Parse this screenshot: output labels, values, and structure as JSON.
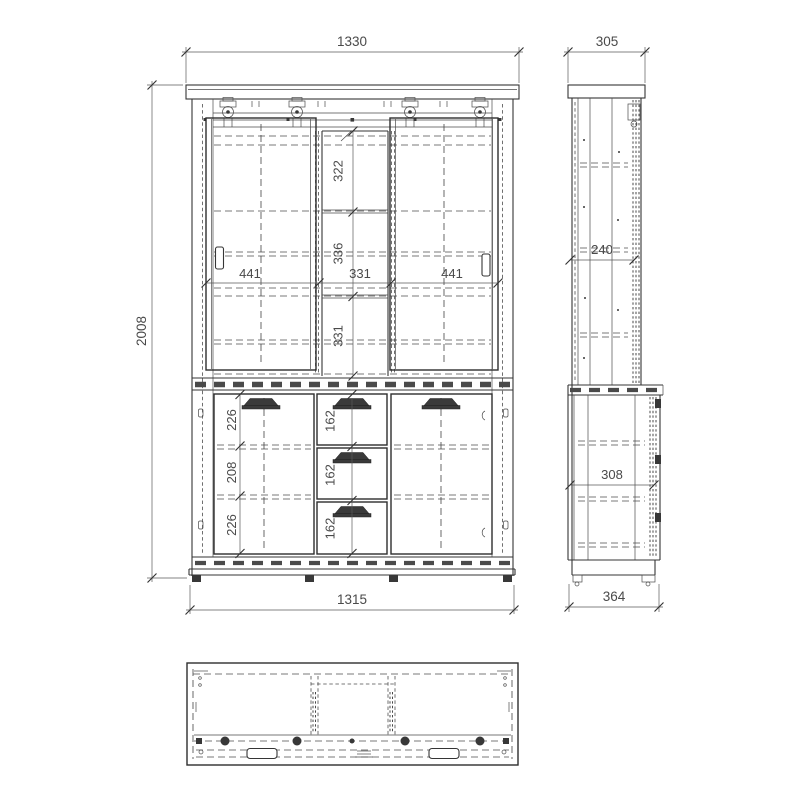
{
  "page": {
    "background": "#ffffff",
    "line_color": "#3a3a3a",
    "dim_text_color": "#4a4a4a"
  },
  "drawing": {
    "type": "furniture-technical-drawing",
    "subject": "display-cabinet-with-sliding-doors",
    "views": {
      "front": {
        "overall_width_mm": "1330",
        "overall_height_mm": "2008",
        "base_width_mm": "1315",
        "left_sliding_door_width_mm": "441",
        "center_section_width_mm": "331",
        "right_sliding_door_width_mm": "441",
        "upper_compartment_heights_mm": [
          "322",
          "336",
          "331"
        ],
        "lower_left_compartment_heights_mm": [
          "226",
          "208",
          "226"
        ],
        "drawer_heights_mm": [
          "162",
          "162",
          "162"
        ]
      },
      "side": {
        "upper_depth_mm": "305",
        "lower_depth_mm": "364",
        "upper_inner_depth_mm": "240",
        "lower_inner_depth_mm": "308"
      }
    }
  }
}
